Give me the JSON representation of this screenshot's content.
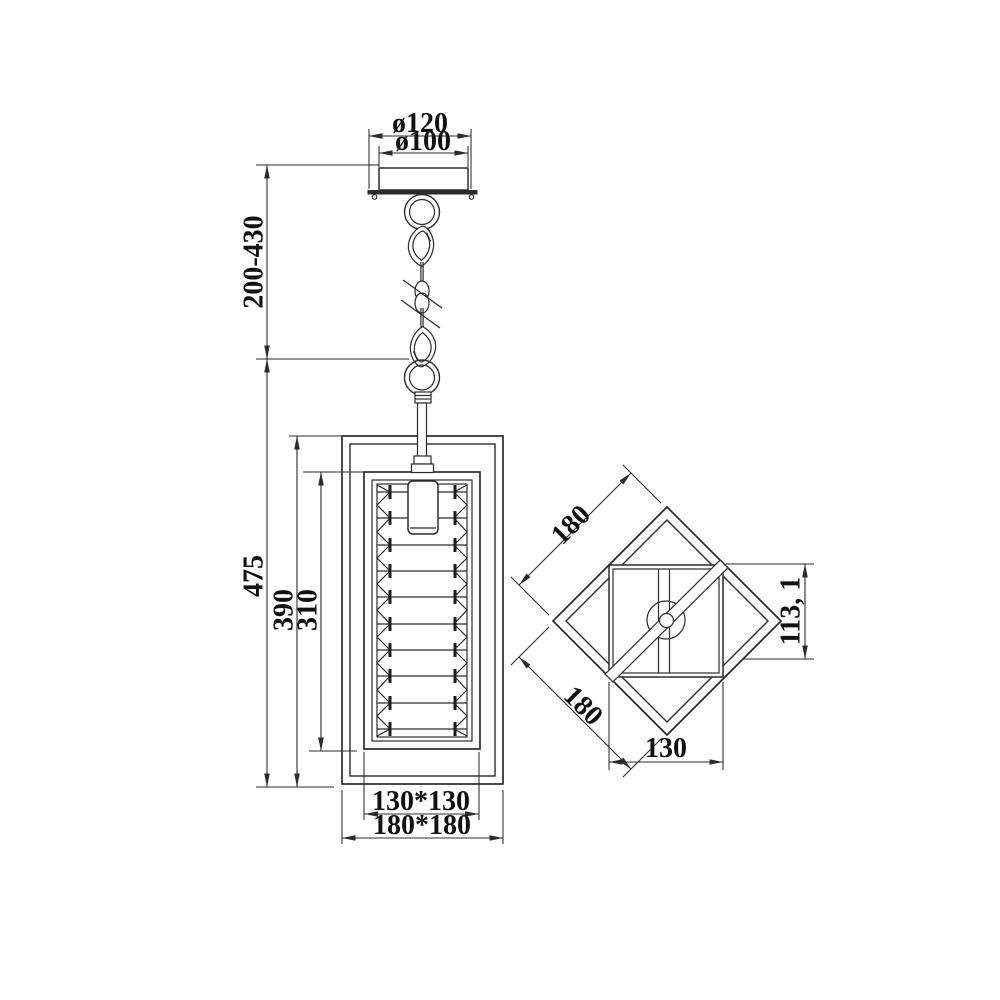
{
  "drawing": {
    "description": "Pendant lamp dimensional technical drawing, front view and top view",
    "colors": {
      "line": "#2b2b2b",
      "text": "#111111",
      "background": "#ffffff"
    },
    "front_view": {
      "canopy_outer_diameter": "ø120",
      "canopy_inner_diameter": "ø100",
      "suspension_height_range": "200-430",
      "overall_body_height": "475",
      "frame_height": "390",
      "shade_height": "310",
      "inner_frame_width": "130*130",
      "outer_frame_width": "180*180"
    },
    "top_view": {
      "edge_width_upper": "180",
      "edge_width_lower": "180",
      "inner_frame_width": "130",
      "diagonal_projection": "113, 1"
    }
  }
}
